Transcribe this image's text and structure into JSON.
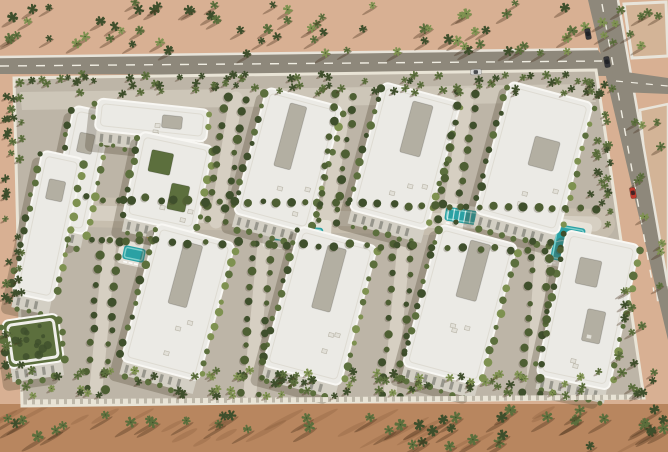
{
  "scene": {
    "type": "aerial-architectural-render",
    "description": "Aerial 3D rendering of a gated desert residential compound: two rows of white low-rise apartment buildings with landscaped courtyards, central pool and water-slide amenity spine, dense palm-tree perimeter, surrounding sand with palm groves, and asphalt roads with cars at the top-right intersection",
    "counts": {
      "building_blocks": 10,
      "pools": 5,
      "cars": 4
    }
  },
  "palette": {
    "sand_top": "#d8b093",
    "sand_top_light": "#e3c3a5",
    "sand_bottom": "#b8865f",
    "sand_shade": "#6b4326",
    "road": "#8e887b",
    "road_line": "#f0ede2",
    "sidewalk": "#e8e4da",
    "plot": "#d3b497",
    "hardscape": "#bdb5a7",
    "path": "#d6cfc2",
    "plaza": "#c7beae",
    "wall": "#e9e4d6",
    "roof": "#ebeae5",
    "roof_edge": "#f8f7f3",
    "roof_inner": "#dedbd2",
    "roof_slot": "#b3afa2",
    "facade": "#d3cfc4",
    "window": "#6f6f68",
    "building_shadow": "rgba(80,70,50,0.30)",
    "green_dark": "#3f4f2c",
    "green_mid": "#5c6f3d",
    "green_light": "#7e9150",
    "canopy": "#4e5f33",
    "pool": "#2aa1a4",
    "pool_light": "#7ed0cc",
    "slide_yellow": "#e3c44c",
    "slide_green": "#79a94f",
    "car_dark": "#35363a",
    "car_red": "#c03a2d",
    "car_silver": "#d8d8d6",
    "palm_shadow": "rgba(70,45,25,0.35)"
  },
  "objects": {
    "buildings": [
      {
        "id": "block-northwest-west-wing",
        "cx": 80,
        "cy": 170,
        "w": 38,
        "h": 124,
        "rot": 12,
        "slots": [
          {
            "dx": 0,
            "dy": -0.22,
            "fw": 0.4,
            "fh": 0.16,
            "court": false
          }
        ]
      },
      {
        "id": "block-northwest-north-wing",
        "cx": 152,
        "cy": 120,
        "w": 112,
        "h": 32,
        "rot": 6,
        "slots": [
          {
            "dx": 0.18,
            "dy": 0,
            "fw": 0.18,
            "fh": 0.4,
            "court": false
          }
        ]
      },
      {
        "id": "block-northwest-inner",
        "cx": 168,
        "cy": 182,
        "w": 74,
        "h": 88,
        "rot": 12,
        "slots": [
          {
            "dx": -0.15,
            "dy": -0.2,
            "fw": 0.3,
            "fh": 0.25,
            "court": true
          },
          {
            "dx": 0.18,
            "dy": 0.15,
            "fw": 0.25,
            "fh": 0.3,
            "court": true
          }
        ]
      },
      {
        "id": "block-north-2",
        "cx": 288,
        "cy": 160,
        "w": 78,
        "h": 130,
        "rot": 15,
        "slots": [
          {
            "dx": -0.05,
            "dy": -0.18,
            "fw": 0.22,
            "fh": 0.5,
            "court": false
          }
        ]
      },
      {
        "id": "block-north-3",
        "cx": 405,
        "cy": 156,
        "w": 80,
        "h": 132,
        "rot": 15,
        "slots": [
          {
            "dx": 0.05,
            "dy": -0.22,
            "fw": 0.26,
            "fh": 0.4,
            "court": false
          }
        ]
      },
      {
        "id": "block-northeast",
        "cx": 534,
        "cy": 158,
        "w": 86,
        "h": 136,
        "rot": 15,
        "slots": [
          {
            "dx": 0.1,
            "dy": -0.05,
            "fw": 0.3,
            "fh": 0.22,
            "court": false
          }
        ]
      },
      {
        "id": "block-west-edge",
        "cx": 48,
        "cy": 226,
        "w": 42,
        "h": 146,
        "rot": 12,
        "slots": [
          {
            "dx": 0,
            "dy": -0.25,
            "fw": 0.4,
            "fh": 0.14,
            "court": false
          }
        ]
      },
      {
        "id": "block-green-roof",
        "cx": 33,
        "cy": 341,
        "w": 56,
        "h": 48,
        "rot": -8,
        "green": true,
        "slots": []
      },
      {
        "id": "block-south-1",
        "cx": 178,
        "cy": 302,
        "w": 80,
        "h": 142,
        "rot": 15,
        "slots": [
          {
            "dx": 0,
            "dy": -0.2,
            "fw": 0.24,
            "fh": 0.45,
            "court": false
          }
        ]
      },
      {
        "id": "block-south-2",
        "cx": 320,
        "cy": 306,
        "w": 80,
        "h": 144,
        "rot": 15,
        "slots": [
          {
            "dx": 0.02,
            "dy": -0.2,
            "fw": 0.24,
            "fh": 0.45,
            "court": false
          }
        ]
      },
      {
        "id": "block-south-3",
        "cx": 460,
        "cy": 305,
        "w": 80,
        "h": 146,
        "rot": 15,
        "slots": [
          {
            "dx": 0.05,
            "dy": -0.25,
            "fw": 0.26,
            "fh": 0.4,
            "court": false
          }
        ]
      },
      {
        "id": "block-southeast",
        "cx": 588,
        "cy": 310,
        "w": 74,
        "h": 148,
        "rot": 12,
        "slots": [
          {
            "dx": -0.1,
            "dy": -0.25,
            "fw": 0.3,
            "fh": 0.18,
            "court": false
          },
          {
            "dx": 0.12,
            "dy": 0.1,
            "fw": 0.25,
            "fh": 0.22,
            "court": false
          }
        ]
      }
    ],
    "pools": [
      {
        "id": "central-lap-pool",
        "cx": 297,
        "cy": 234,
        "w": 52,
        "h": 15,
        "rot": 3,
        "deck": 8,
        "lane": true
      },
      {
        "id": "kids-pool",
        "cx": 134,
        "cy": 254,
        "w": 22,
        "h": 14,
        "rot": 12,
        "deck": 5
      },
      {
        "id": "pergola-shaded-pool",
        "cx": 462,
        "cy": 216,
        "w": 34,
        "h": 14,
        "rot": 9,
        "deck": 4,
        "pergola": true
      },
      {
        "id": "east-wave-pool",
        "cx": 568,
        "cy": 244,
        "w": 30,
        "h": 36,
        "rot": 10,
        "deck": 6,
        "wavy": true
      },
      {
        "id": "northeast-courtyard-pool",
        "cx": 560,
        "cy": 126,
        "w": 30,
        "h": 32,
        "rot": 14,
        "deck": 6,
        "wavy": true
      }
    ],
    "cars": [
      {
        "id": "car-dark-1",
        "x": 588,
        "y": 34,
        "rot": 80,
        "color": "car_dark"
      },
      {
        "id": "car-dark-2",
        "x": 607,
        "y": 62,
        "rot": 80,
        "color": "car_dark"
      },
      {
        "id": "car-red",
        "x": 633,
        "y": 193,
        "rot": 80,
        "color": "car_red"
      },
      {
        "id": "car-silver",
        "x": 476,
        "y": 72,
        "rot": -2,
        "color": "car_silver"
      }
    ],
    "tree_lines": [
      {
        "x1": 236,
        "y1": 98,
        "x2": 216,
        "y2": 222,
        "n": 10,
        "off": 9
      },
      {
        "x1": 346,
        "y1": 96,
        "x2": 326,
        "y2": 222,
        "n": 10,
        "off": 9
      },
      {
        "x1": 468,
        "y1": 94,
        "x2": 448,
        "y2": 220,
        "n": 10,
        "off": 9
      },
      {
        "x1": 110,
        "y1": 242,
        "x2": 96,
        "y2": 388,
        "n": 11,
        "off": 9
      },
      {
        "x1": 264,
        "y1": 244,
        "x2": 250,
        "y2": 392,
        "n": 11,
        "off": 9
      },
      {
        "x1": 404,
        "y1": 244,
        "x2": 390,
        "y2": 394,
        "n": 11,
        "off": 9
      },
      {
        "x1": 542,
        "y1": 242,
        "x2": 532,
        "y2": 394,
        "n": 11,
        "off": 9
      },
      {
        "x1": 88,
        "y1": 198,
        "x2": 596,
        "y2": 210,
        "n": 36,
        "off": 0
      },
      {
        "x1": 92,
        "y1": 240,
        "x2": 560,
        "y2": 250,
        "n": 30,
        "off": 0
      }
    ],
    "palm_regions": [
      {
        "name": "sand-palms-top",
        "x": 2,
        "y": 2,
        "w": 586,
        "h": 52,
        "n": 68,
        "smin": 3,
        "smax": 4.6,
        "cols": [
          "green_mid",
          "green_light",
          "green_dark"
        ],
        "sh": 7
      },
      {
        "name": "sand-palms-top-right",
        "x": 600,
        "y": 4,
        "w": 66,
        "h": 42,
        "n": 10,
        "smin": 3,
        "smax": 4.2,
        "cols": [
          "green_mid",
          "green_light"
        ],
        "sh": 7
      },
      {
        "name": "perimeter-palms-north",
        "x": 20,
        "y": 74,
        "w": 574,
        "h": 20,
        "n": 80,
        "smin": 2.6,
        "smax": 3.8,
        "cols": [
          "green_dark",
          "green_mid"
        ],
        "sh": 3
      },
      {
        "name": "perimeter-palms-south",
        "x": 24,
        "y": 370,
        "w": 600,
        "h": 26,
        "n": 90,
        "smin": 2.8,
        "smax": 4,
        "cols": [
          "green_dark",
          "green_mid",
          "green_light"
        ],
        "sh": 3
      },
      {
        "name": "perimeter-palms-west",
        "x": 4,
        "y": 84,
        "w": 18,
        "h": 296,
        "n": 38,
        "smin": 2.6,
        "smax": 3.8,
        "cols": [
          "green_dark",
          "green_mid"
        ],
        "sh": 3
      },
      {
        "name": "perimeter-palms-east",
        "x": 590,
        "y": 84,
        "w": 24,
        "h": 150,
        "n": 26,
        "smin": 2.6,
        "smax": 3.6,
        "cols": [
          "green_dark",
          "green_mid"
        ],
        "sh": 3
      },
      {
        "name": "corner-palms-southeast",
        "x": 616,
        "y": 300,
        "w": 50,
        "h": 96,
        "n": 14,
        "smin": 3,
        "smax": 4.2,
        "cols": [
          "green_dark",
          "green_mid"
        ],
        "sh": 5
      },
      {
        "name": "sand-palms-bottom",
        "x": 0,
        "y": 408,
        "w": 668,
        "h": 40,
        "n": 46,
        "smin": 3.6,
        "smax": 5,
        "cols": [
          "green_dark",
          "green_mid"
        ],
        "sh": 11
      },
      {
        "name": "roadside-palms-east",
        "x": 622,
        "y": 96,
        "w": 42,
        "h": 200,
        "n": 12,
        "smin": 2.8,
        "smax": 4,
        "cols": [
          "green_mid",
          "green_light"
        ],
        "sh": 6
      }
    ]
  }
}
